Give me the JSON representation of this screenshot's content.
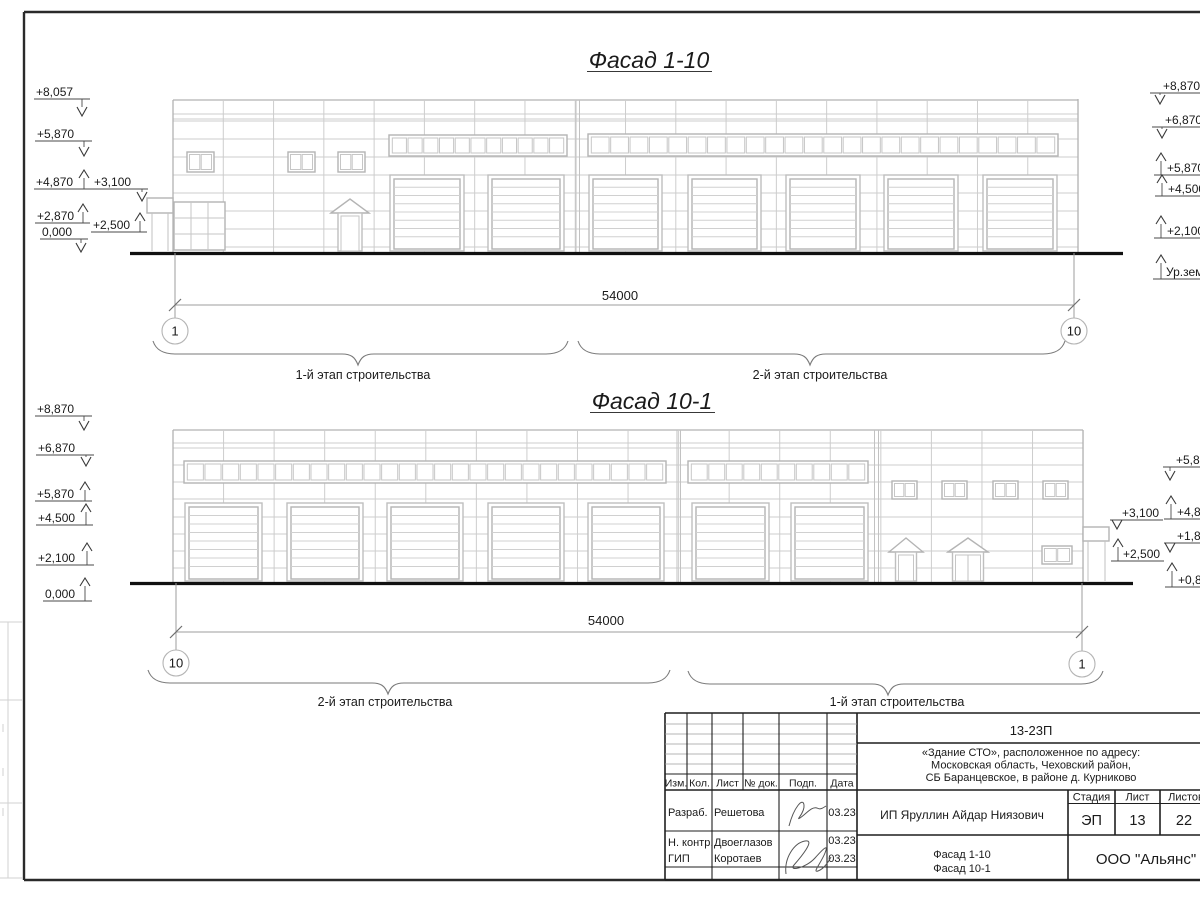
{
  "f1": {
    "title": "Фасад 1-10",
    "dim": "54000",
    "axis_left": "1",
    "axis_right": "10",
    "stage_left": "1-й этап строительства",
    "stage_right": "2-й этап строительства",
    "marks_left": [
      "+8,057",
      "+5,870",
      "+4,870",
      "+3,100",
      "+2,870",
      "+2,500",
      "0,000"
    ],
    "marks_right": [
      "+8,870",
      "+6,870",
      "+5,870",
      "+4,500",
      "+2,100",
      "Ур.зем"
    ]
  },
  "f2": {
    "title": "Фасад 10-1",
    "dim": "54000",
    "axis_left": "10",
    "axis_right": "1",
    "stage_left": "2-й этап строительства",
    "stage_right": "1-й этап строительства",
    "marks_left": [
      "+8,870",
      "+6,870",
      "+5,870",
      "+4,500",
      "+2,100",
      "0,000"
    ],
    "marks_canopy": [
      "+3,100",
      "+2,500"
    ],
    "marks_right": [
      "+5,8",
      "+4,8",
      "+1,8",
      "+0,8"
    ]
  },
  "title_block": {
    "doc_number": "13-23П",
    "project": [
      "«Здание СТО», расположенное по адресу:",
      "Московская область, Чеховский район,",
      "СБ Баранцевское, в районе д. Курниково"
    ],
    "cols": [
      "Изм.",
      "Кол.",
      "Лист",
      "№ док.",
      "Подп.",
      "Дата"
    ],
    "rows": [
      {
        "role": "Разраб.",
        "name": "Решетова",
        "date": "03.23"
      },
      {
        "role": "Н. контр.",
        "name": "Двоеглазов",
        "date": "03.23"
      },
      {
        "role": "ГИП",
        "name": "Коротаев",
        "date": "03.23"
      }
    ],
    "client": "ИП Яруллин Айдар Ниязович",
    "stage_h": "Стадия",
    "sheet_h": "Лист",
    "sheets_h": "Листов",
    "stage": "ЭП",
    "sheet": "13",
    "sheets": "22",
    "drawing_titles": [
      "Фасад 1-10",
      "Фасад 10-1"
    ],
    "org": "ООО \"Альянс\""
  },
  "colors": {
    "ink": "#1a1a1a",
    "wall_line": "#cdcdcd",
    "frame_line": "#2a2a2a"
  }
}
